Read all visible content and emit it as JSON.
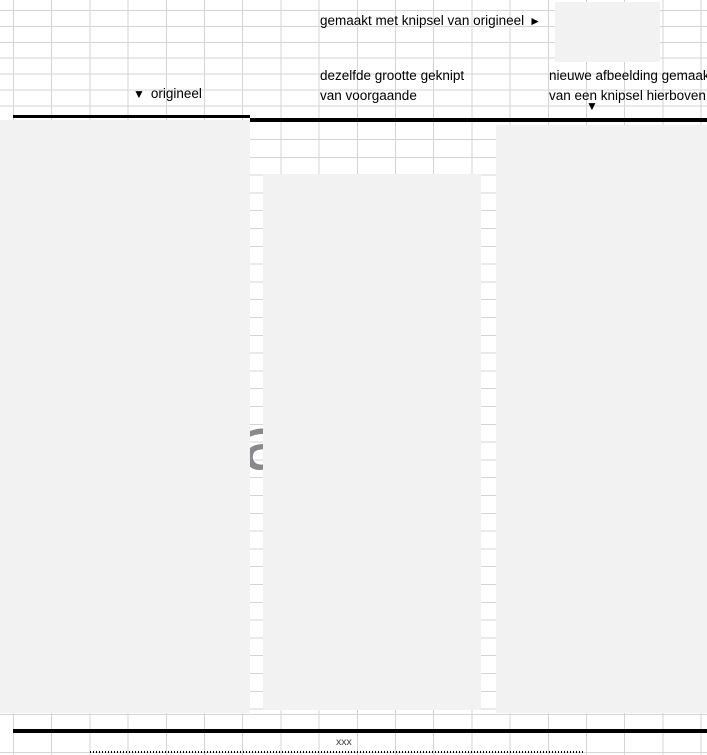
{
  "colors": {
    "gridline": "#d4d4d4",
    "image_fill": "#f2f2f2",
    "border": "#000000",
    "hidden_letter": "#87898c"
  },
  "icons": {
    "right_arrow": "►",
    "down_arrow": "▼"
  },
  "annotations": {
    "made_with_snip": "gemaakt met knipsel van origineel",
    "original": "origineel",
    "same_size_line1": "dezelfde grootte geknipt",
    "same_size_line2": "van voorgaande",
    "new_image_line1": "nieuwe afbeelding gemaakt",
    "new_image_line2": "van een knipsel hierboven",
    "bottom_note": "xxx"
  },
  "hidden_letter": "a"
}
